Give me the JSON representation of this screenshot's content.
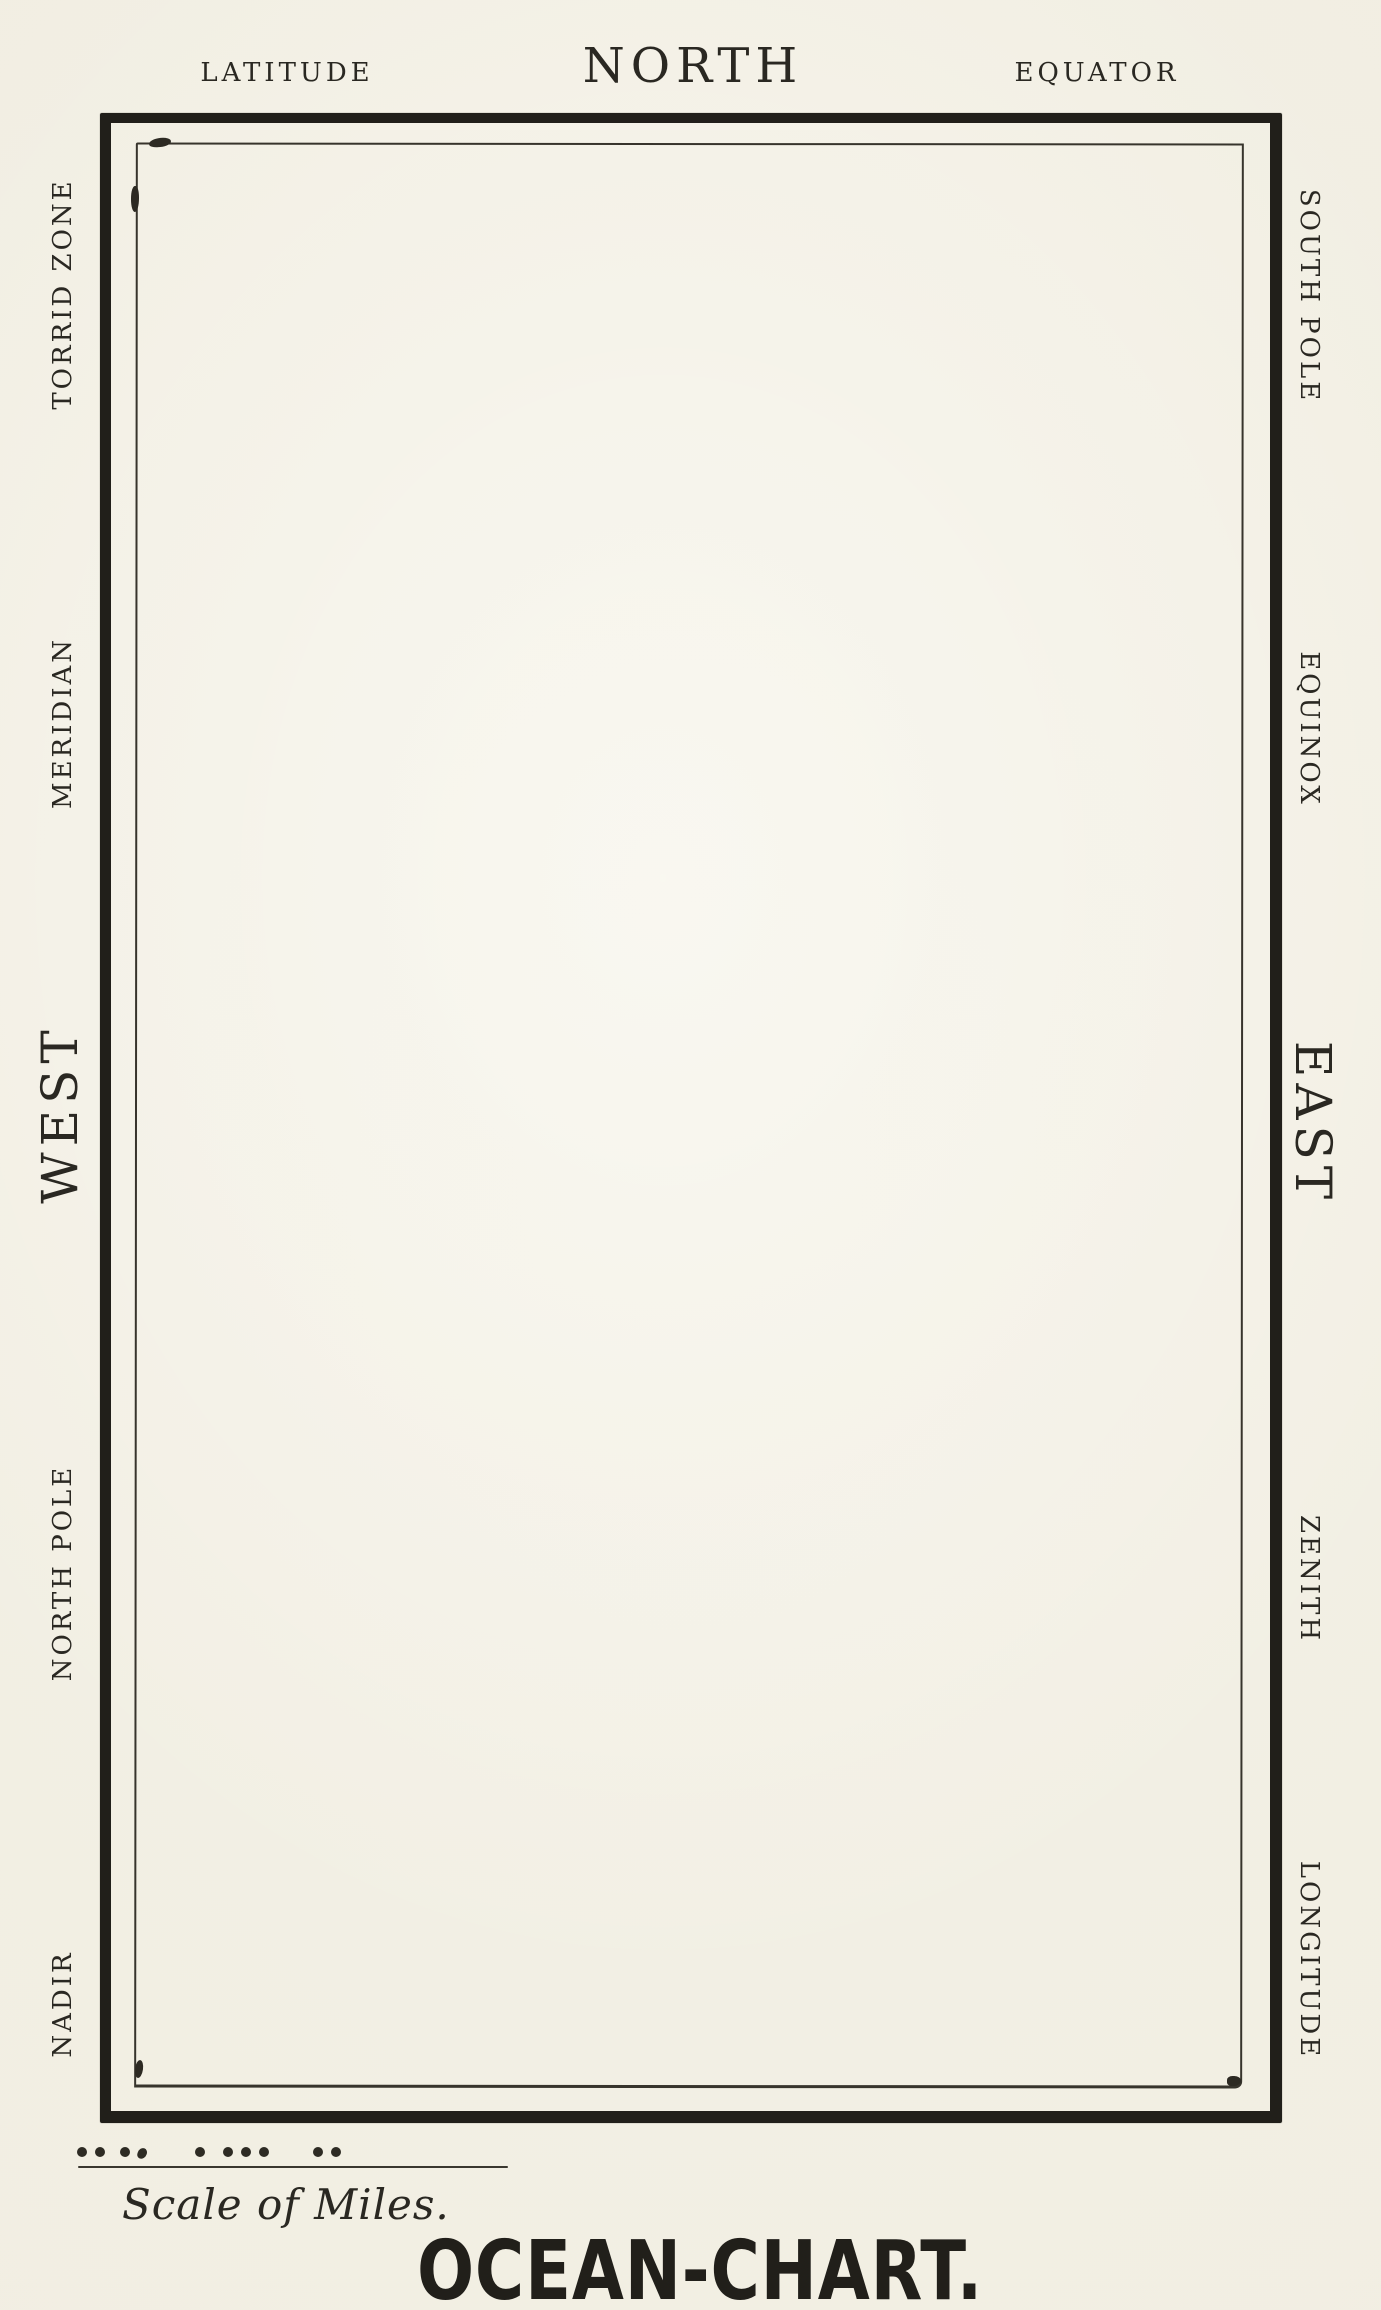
{
  "illustration": {
    "title": "OCEAN-CHART.",
    "colors": {
      "paper": "#f1eee2",
      "ink": "#2a2822",
      "frame": "#211f1a"
    },
    "top_labels": {
      "latitude": "LATITUDE",
      "north": "NORTH",
      "equator": "EQUATOR"
    },
    "left_labels": {
      "torrid_zone": "TORRID ZONE",
      "meridian": "MERIDIAN",
      "west": "WEST",
      "north_pole": "NORTH POLE",
      "nadir": "NADIR"
    },
    "right_labels": {
      "south_pole": "SOUTH POLE",
      "equinox": "EQUINOX",
      "east": "EAST",
      "zenith": "ZENITH",
      "longitude": "LONGITUDE"
    },
    "scale": {
      "caption": "Scale of Miles.",
      "dot_groups": [
        "..",
        ".,",
        ".",
        "...",
        ".."
      ]
    }
  }
}
